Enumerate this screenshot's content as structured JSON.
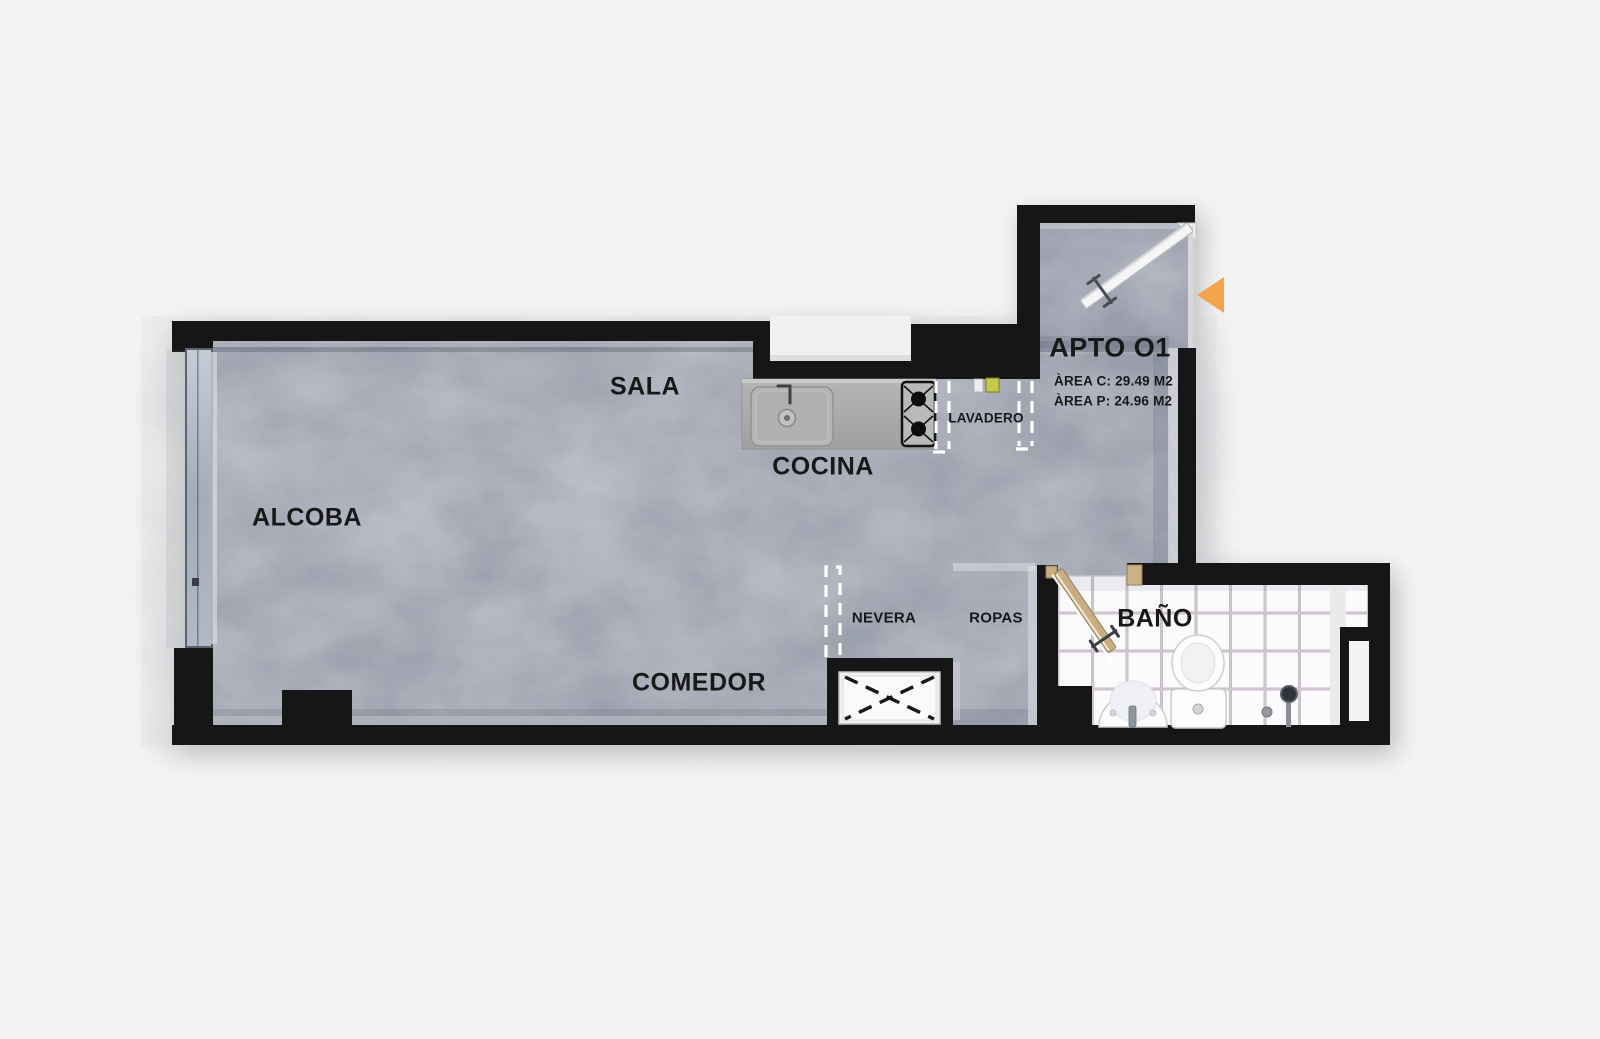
{
  "unit": {
    "title": "APTO O1",
    "area_line1": "ÀREA C: 29.49 M2",
    "area_line2": "ÀREA P: 24.96 M2"
  },
  "rooms": {
    "alcoba": "ALCOBA",
    "sala": "SALA",
    "cocina": "COCINA",
    "comedor": "COMEDOR",
    "bano": "BAÑO",
    "lavadero": "LAVADERO",
    "nevera": "NEVERA",
    "ropas": "ROPAS"
  },
  "colors": {
    "background": "#f4f4f3",
    "wall": "#161616",
    "floor_concrete": "#99a0ad",
    "bathroom_tile": "#f8f8fa",
    "kitchen_counter": "#ababa9",
    "door_wood": "#c9ad82",
    "entry_arrow": "#f4a44c",
    "label_text": "#181818"
  },
  "icons": {
    "entry_arrow": "left-pointing-triangle"
  }
}
